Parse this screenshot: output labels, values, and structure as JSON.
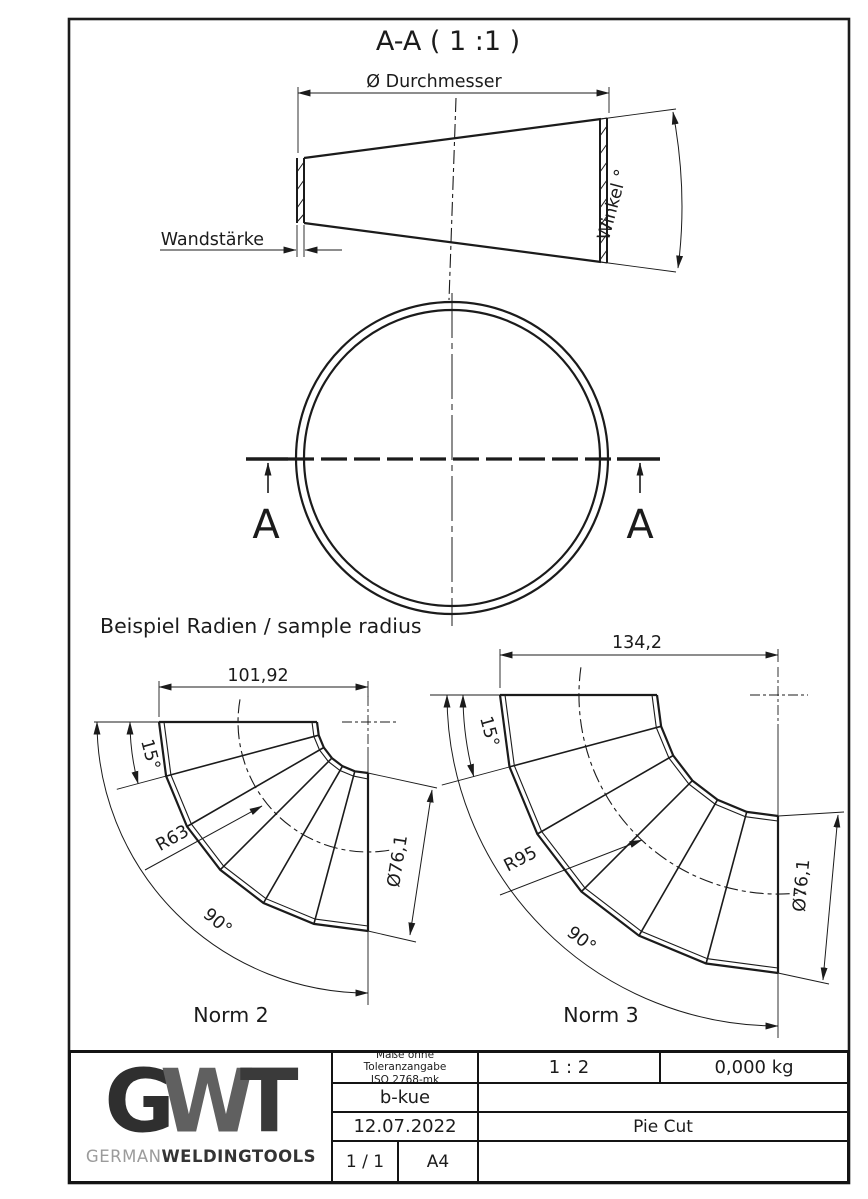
{
  "colors": {
    "line": "#1b1b1b",
    "background": "#ffffff",
    "logo_dark": "#2f2f2f",
    "logo_mid": "#606060",
    "brand_light": "#9b9b9b",
    "brand_dark": "#343434"
  },
  "drawing": {
    "section_view": {
      "title": "A-A ( 1 :1 )",
      "diameter_label": "Ø Durchmesser",
      "wall_label": "Wandstärke",
      "angle_label": "Winkel °"
    },
    "section_marker": "A",
    "samples": {
      "heading": "Beispiel Radien / sample radius",
      "norm2": {
        "name": "Norm 2",
        "width": "101,92",
        "segment_angle": "15°",
        "bend_radius": "R63",
        "arc_angle": "90°",
        "pipe_diameter": "Ø76,1"
      },
      "norm3": {
        "name": "Norm 3",
        "width": "134,2",
        "segment_angle": "15°",
        "bend_radius": "R95",
        "arc_angle": "90°",
        "pipe_diameter": "Ø76,1"
      }
    }
  },
  "title_block": {
    "tolerance_line1": "Maße ohne Toleranzangabe",
    "tolerance_line2": "ISO 2768-mk",
    "scale": "1 : 2",
    "weight": "0,000 kg",
    "author": "b-kue",
    "date": "12.07.2022",
    "part_name": "Pie Cut",
    "sheet": "1 / 1",
    "format": "A4",
    "logo": {
      "g": "G",
      "w": "W",
      "t": "T",
      "brand_light": "GERMAN",
      "brand_bold": "WELDINGTOOLS"
    }
  }
}
